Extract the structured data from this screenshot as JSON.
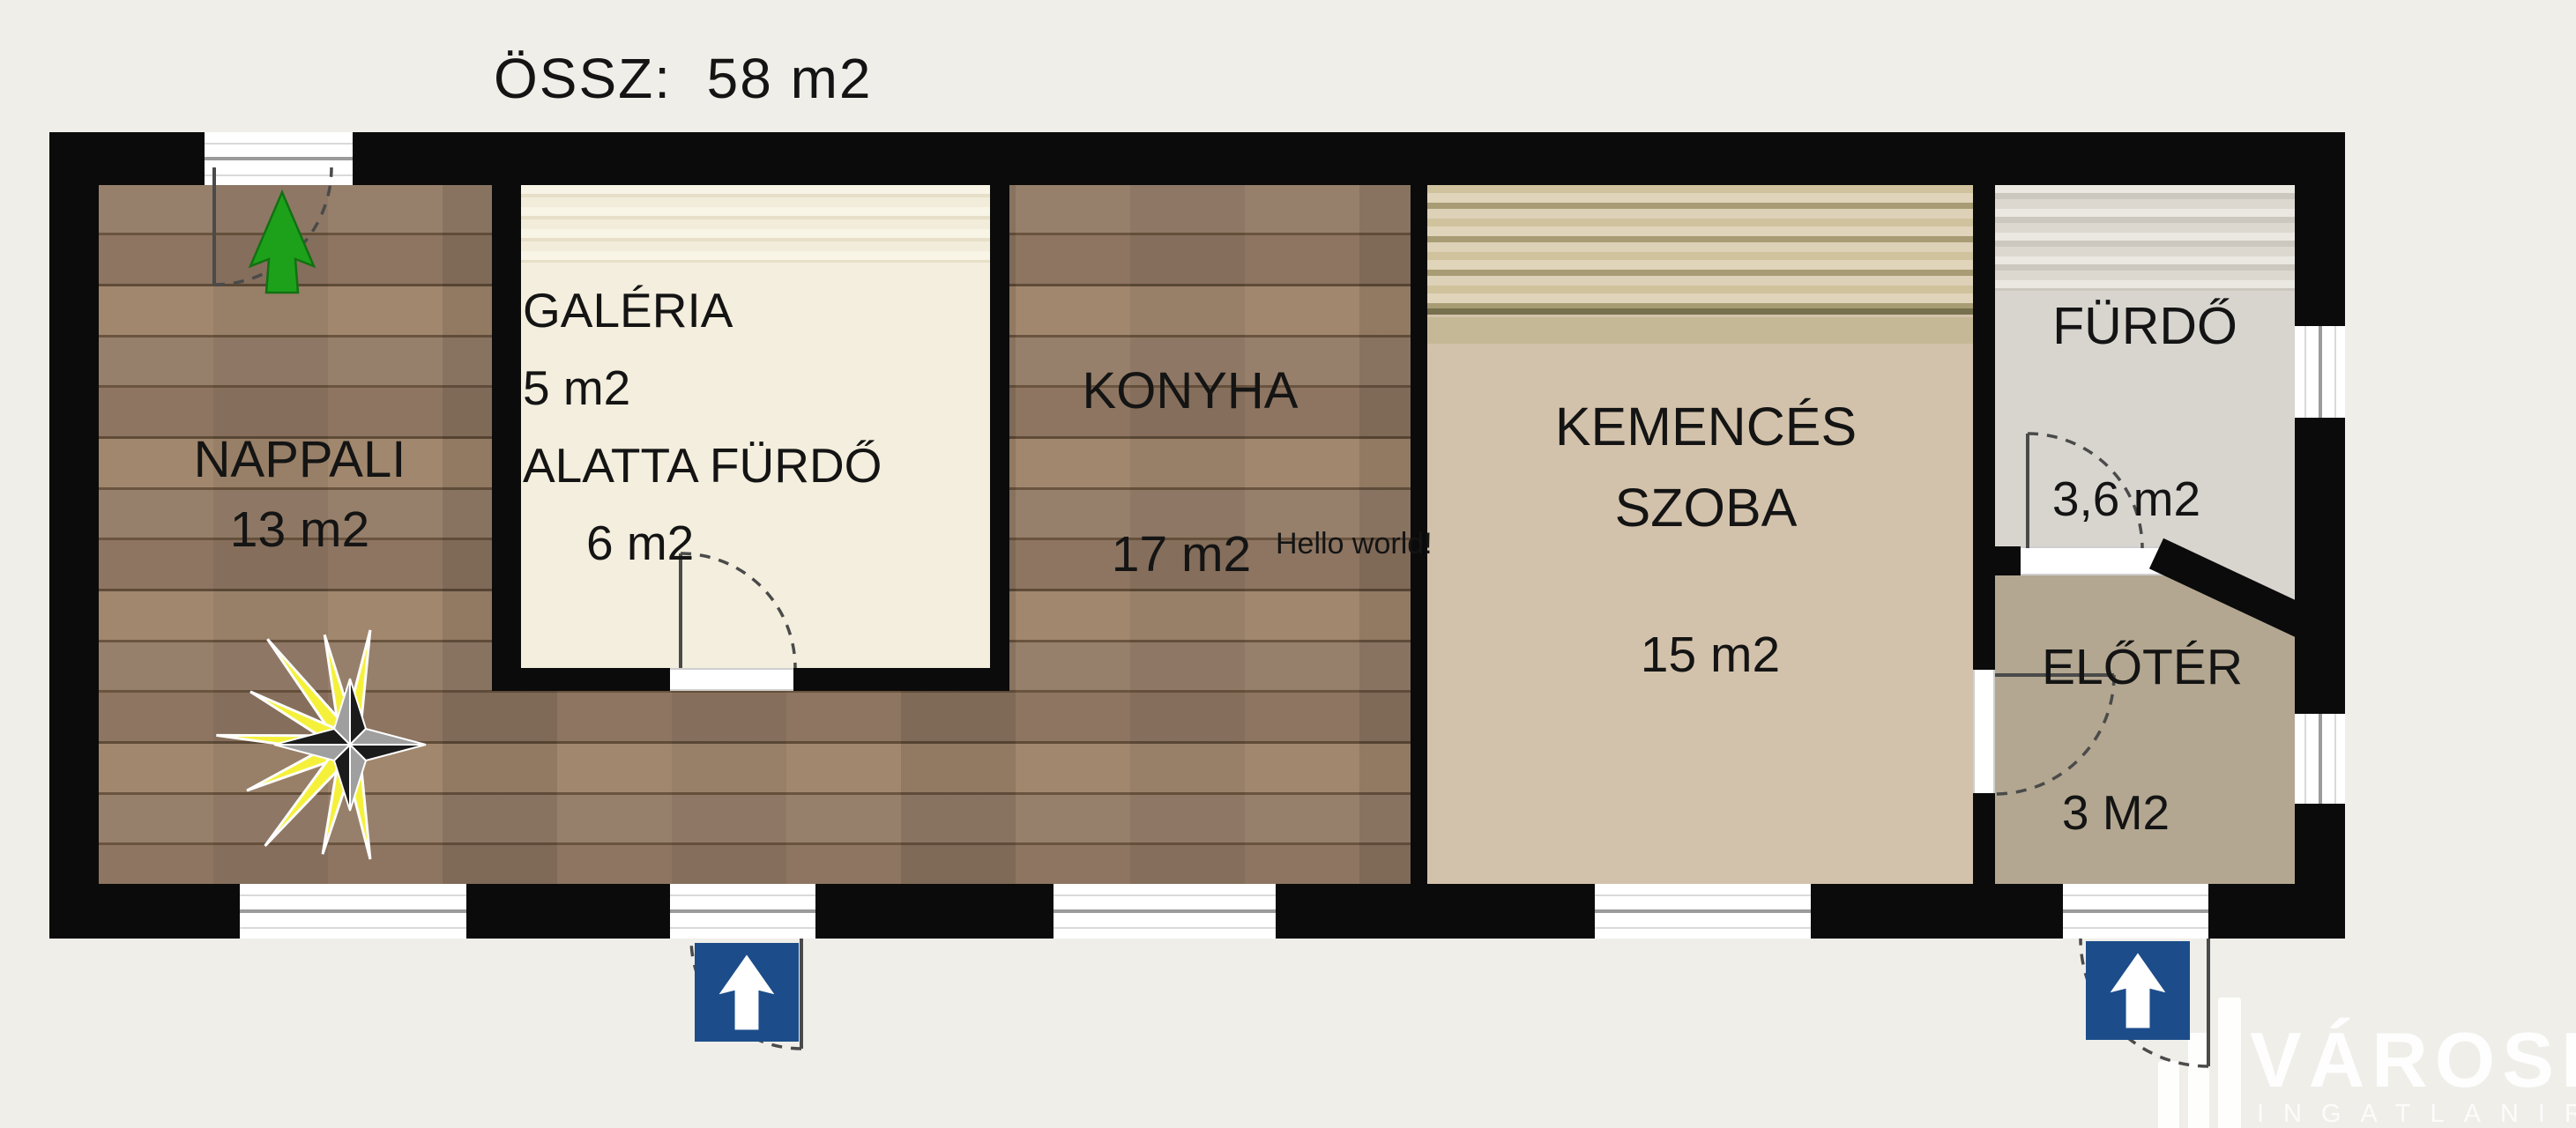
{
  "title": "ÖSSZ:  58 m2",
  "rooms": {
    "nappali": {
      "name": "NAPPALI",
      "area": "13 m2"
    },
    "galeria": {
      "name": "GALÉRIA",
      "area": "5 m2",
      "note": "ALATTA FÜRDŐ",
      "note_area": "6 m2"
    },
    "konyha": {
      "name": "KONYHA",
      "area": "17 m2"
    },
    "kemences_szoba": {
      "name_line1": "KEMENCÉS",
      "name_line2": "SZOBA",
      "area": "15 m2"
    },
    "furdo": {
      "name": "FÜRDŐ",
      "area": "3,6 m2"
    },
    "eloter": {
      "name": "ELŐTÉR",
      "area": "3 M2"
    }
  },
  "annotations": {
    "hello_world": "Hello world!"
  },
  "logo": {
    "brand": "VÁROSI",
    "subtitle": "INGATLANIRODA"
  },
  "icons": [
    "north-arrow-icon",
    "compass-rose-icon",
    "entrance-arrow-icon",
    "building-logo-icon"
  ],
  "colors": {
    "wall": "#0b0b0b",
    "background": "#efeee9",
    "wood_floor": "#8c7662",
    "galeria_floor": "#f3eedd",
    "kemences_floor": "#d3c2ab",
    "furdo_floor": "#d8d5cf",
    "eloter_floor": "#b3a791",
    "entrance_arrow_blue": "#1c4d8a",
    "north_arrow_green": "#1da11a",
    "compass_yellow": "#f5f13b"
  }
}
